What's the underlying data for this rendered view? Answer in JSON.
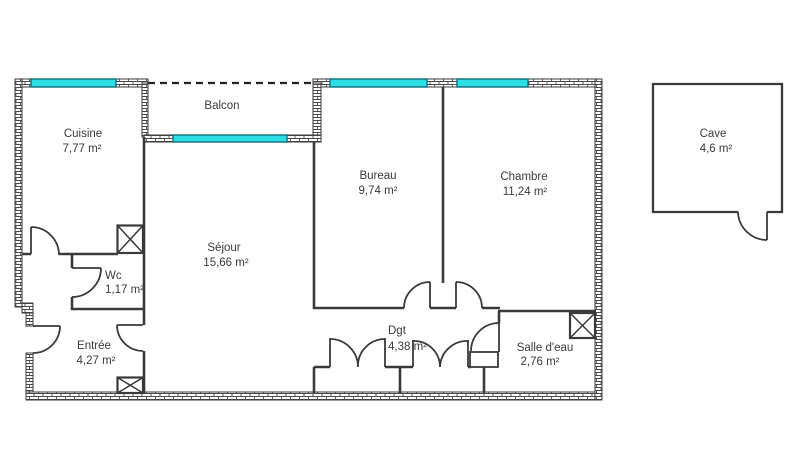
{
  "rooms": {
    "cuisine": {
      "name": "Cuisine",
      "area": "7,77 m²"
    },
    "balcon": {
      "name": "Balcon",
      "area": ""
    },
    "sejour": {
      "name": "Séjour",
      "area": "15,66 m²"
    },
    "bureau": {
      "name": "Bureau",
      "area": "9,74 m²"
    },
    "chambre": {
      "name": "Chambre",
      "area": "11,24 m²"
    },
    "wc": {
      "name": "Wc",
      "area": "1,17 m²"
    },
    "entree": {
      "name": "Entrée",
      "area": "4,27 m²"
    },
    "dgt": {
      "name": "Dgt",
      "area": "4,38 m²"
    },
    "salledeau": {
      "name": "Salle d'eau",
      "area": "2,76 m²"
    },
    "cave": {
      "name": "Cave",
      "area": "4,6 m²"
    }
  },
  "colors": {
    "window_fill": "#2EDEE6",
    "window_border": "#0C6E78",
    "wall_line": "#3a3a3a",
    "text": "#3a3a3a",
    "background": "#ffffff"
  }
}
